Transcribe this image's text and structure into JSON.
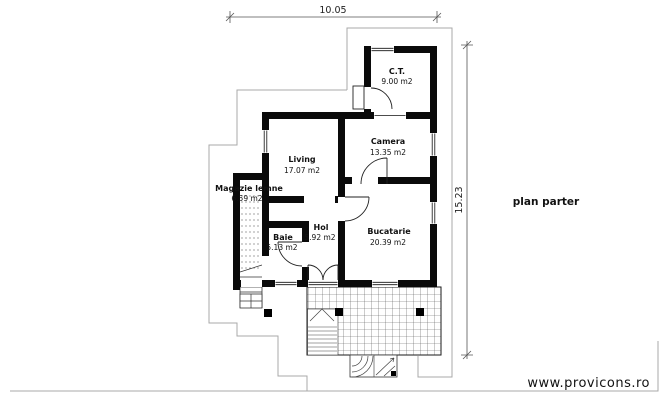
{
  "plan": {
    "title": "plan parter",
    "watermark": "www.provicons.ro",
    "dimensions": {
      "width": "10.05",
      "height": "15.23"
    },
    "rooms": [
      {
        "name": "C.T.",
        "area": "9.00 m2"
      },
      {
        "name": "Camera",
        "area": "13.35 m2"
      },
      {
        "name": "Living",
        "area": "17.07 m2"
      },
      {
        "name": "Magazie lemne",
        "area": "6.59 m2"
      },
      {
        "name": "Baie",
        "area": "5.13 m2"
      },
      {
        "name": "Hol",
        "area": "5.92 m2"
      },
      {
        "name": "Bucatarie",
        "area": "20.39 m2"
      }
    ],
    "colors": {
      "wall": "#0a0a0a",
      "site_outline": "#a9a9a9",
      "dimension": "#555555",
      "watermark": "#9c9c9c"
    }
  }
}
